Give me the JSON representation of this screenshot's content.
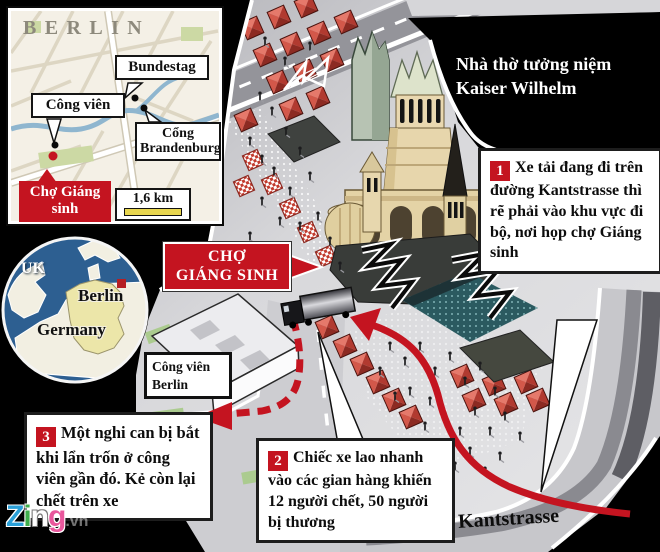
{
  "inset": {
    "title": "BERLIN",
    "bundestag": "Bundestag",
    "park": "Công viên",
    "gate_line1": "Cổng",
    "gate_line2": "Brandenburg",
    "market_line1": "Chợ Giáng",
    "market_line2": "sinh",
    "scale": "1,6 km"
  },
  "locator": {
    "uk": "UK",
    "berlin": "Berlin",
    "germany": "Germany"
  },
  "scene": {
    "church_caption": "Nhà thờ tưởng niệm Kaiser Wilhelm",
    "market_line1": "CHỢ",
    "market_line2": "GIÁNG SINH",
    "park_line1": "Công viên",
    "park_line2": "Berlin",
    "street": "Kantstrasse"
  },
  "callouts": [
    {
      "num": "1",
      "text": "Xe tải đang đi trên đường Kantstrasse thì rẽ phải vào khu vực đi bộ, nơi họp chợ Giáng sinh"
    },
    {
      "num": "2",
      "text": "Chiếc xe lao nhanh vào các gian hàng khiến 12 người chết, 50 người bị thương"
    },
    {
      "num": "3",
      "text": "Một nghi can bị bắt khi lẩn trốn ở công viên gần đó. Kẻ còn lại chết trên xe"
    }
  ],
  "watermark": {
    "z": "Z",
    "i": "i",
    "n": "n",
    "g": "g",
    "suffix": ".vn"
  },
  "colors": {
    "accent_red": "#c41420",
    "sea_blue": "#2d5f91",
    "germany_yellow": "#ece6a9",
    "stall_red": "#c0392b"
  }
}
